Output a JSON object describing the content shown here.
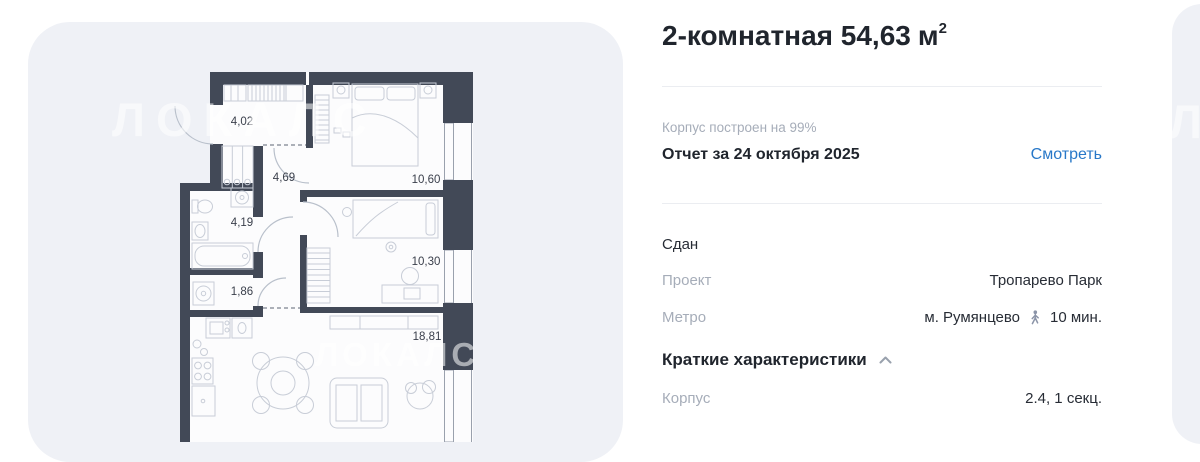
{
  "colors": {
    "card_background": "#eff1f6",
    "wall": "#424957",
    "link_blue": "#2878c8",
    "label_gray": "#a6adb9",
    "text_dark": "#20252d",
    "furniture_line": "#c8cdd7"
  },
  "watermark": {
    "text": "ЛОКАЛС",
    "partial": "ЛО"
  },
  "floorplan": {
    "rooms": [
      {
        "id": "hallway",
        "area": "4,02"
      },
      {
        "id": "corridor",
        "area": "4,69"
      },
      {
        "id": "bathroom",
        "area": "4,19"
      },
      {
        "id": "wc",
        "area": "1,86"
      },
      {
        "id": "bedroom-1",
        "area": "10,60"
      },
      {
        "id": "bedroom-2",
        "area": "10,30"
      },
      {
        "id": "living-kitchen",
        "area": "18,81"
      }
    ]
  },
  "panel": {
    "title": {
      "main": "2-комнатная 54,63",
      "unit": "м",
      "sup": "2"
    },
    "progress": "Корпус построен на 99%",
    "report": {
      "title": "Отчет за 24 октября 2025",
      "action": "Смотреть"
    },
    "status": "Сдан",
    "project": {
      "label": "Проект",
      "value": "Тропарево Парк"
    },
    "metro": {
      "label": "Метро",
      "station": "м. Румянцево",
      "time": "10 мин."
    },
    "section_title": "Краткие характеристики",
    "building": {
      "label": "Корпус",
      "value": "2.4, 1 секц."
    }
  }
}
